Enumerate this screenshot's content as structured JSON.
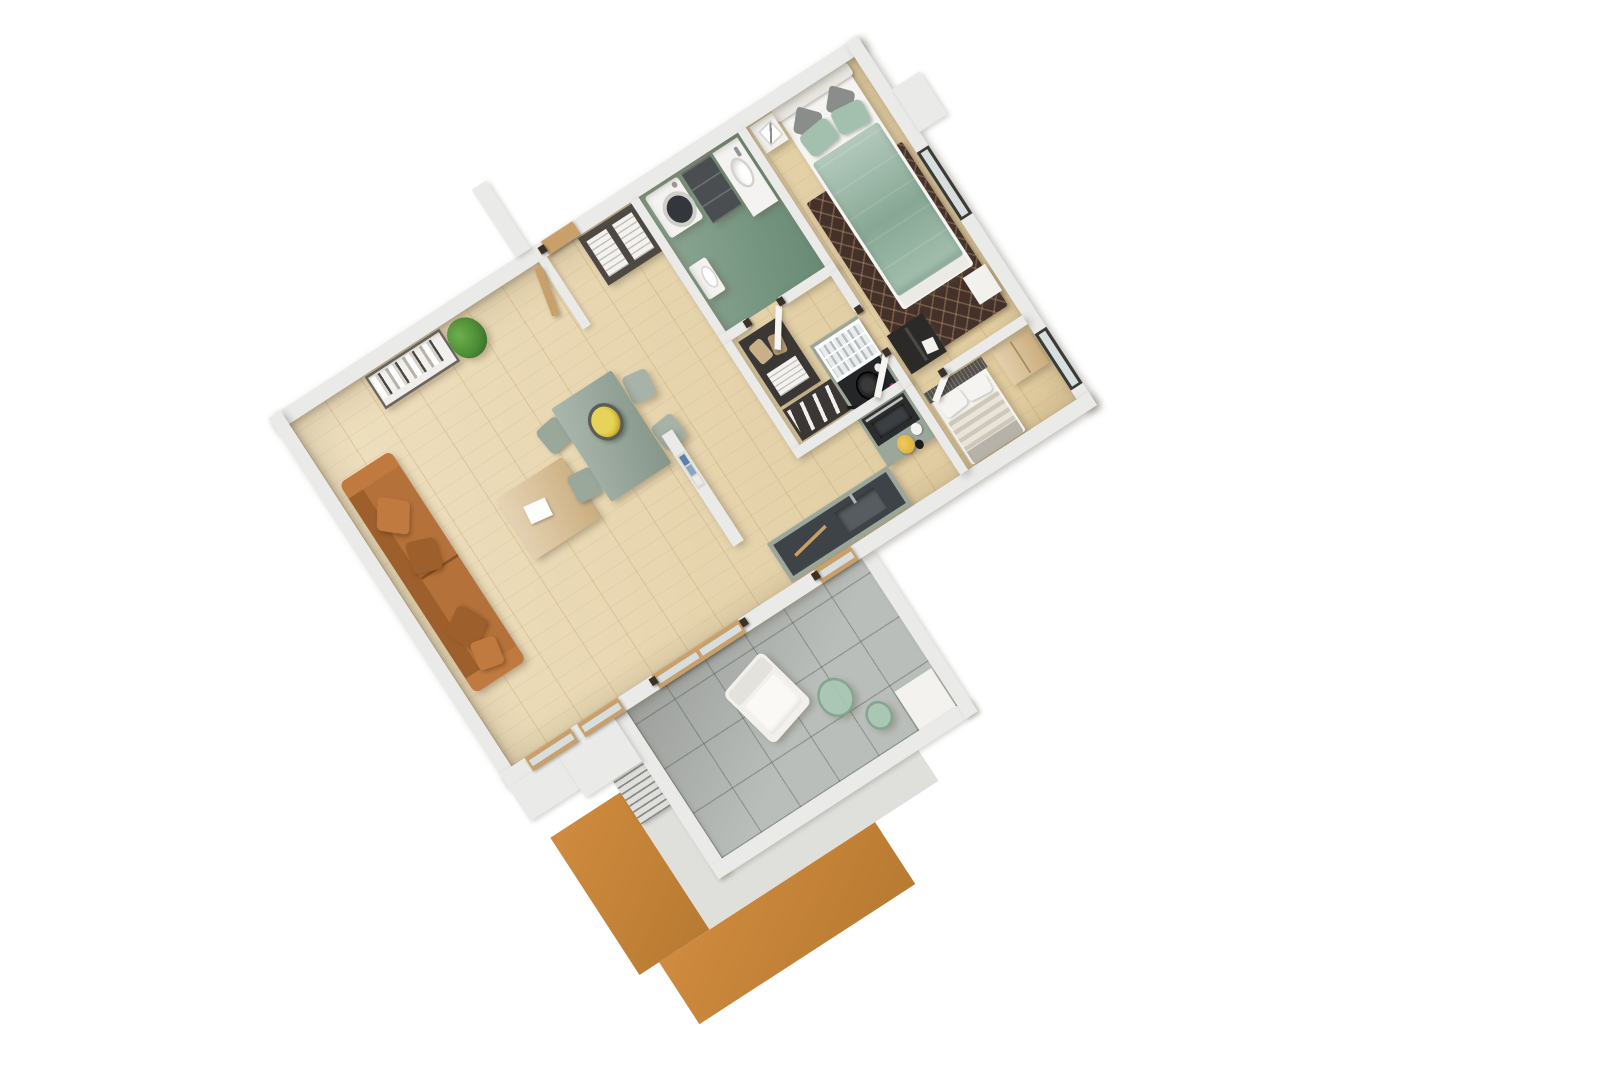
{
  "view": {
    "type": "3D floor plan render",
    "projection": "rotated top-down axonometric",
    "rotation_deg": -33,
    "background": "#ffffff",
    "visible_text": "none"
  },
  "palette": {
    "wall": "#eaeae8",
    "wall_edge": "#d6d6d3",
    "wood_floor": "#e7d2a4",
    "bathroom_floor": "#74957f",
    "balcony_tile": "#babeba",
    "parapet": "#dfdfdc",
    "facade_orange": "#cf8b3f",
    "facade_orange_dark": "#b87a31",
    "sofa": "#b5713a",
    "sofa_dark": "#9d5f2b",
    "sofa_light": "#c07a40",
    "coffee_table": "#d9bd8e",
    "plant_green": "#4c8c36",
    "dining_table": "#93a396",
    "chair": "#9aa89c",
    "fruit_yellow": "#d9c43f",
    "kitchen_cabinet": "#9aa79a",
    "counter_dark": "#3e4347",
    "appliance_dark": "#2a2c2d",
    "steel": "#c8ccce",
    "knob_pink": "#c2366a",
    "bowl_yellow": "#e0b33c",
    "bed_duvet": "#95b5a2",
    "bed_pillow": "#a3c0ae",
    "cushion_gray": "#8b8d8a",
    "mattress_white": "#f5f4f1",
    "rug_brown": "#43312a",
    "rug_pattern": "#8a6e55",
    "nightstand": "#f2f1ee",
    "black_cabinet": "#2b2a28",
    "wardrobe_dark": "#4d4843",
    "linen_white": "#f3f2ef",
    "washer_white": "#f4f3f1",
    "washer_drum": "#33363a",
    "vanity_dark": "#4a4e51",
    "toilet_white": "#f3f2ef",
    "closet_shelf": "#3b3734",
    "shoe_white": "#f1efec",
    "bag_beige": "#c9b089",
    "stripe_light": "#e9e4da",
    "stripe_dark": "#cfc8ba",
    "headboard_mesh": "#55524d",
    "blanket_gray": "#b7b2a9",
    "wood_wardrobe": "#d9bc8c",
    "wood_frame": "#c9a069",
    "window_frame": "#3a3a37",
    "glass": "#d7dede",
    "armchair_white": "#f1f0ed",
    "glass_table": "#a9c7b4",
    "glass_table_ring": "#7fa38e",
    "metal_rail": "#8e8f8b",
    "book_blue": "#5b7fa6",
    "book_light": "#88a7c4"
  },
  "rooms": [
    {
      "id": "living-room",
      "name": "Living room",
      "floor": "light wood planks"
    },
    {
      "id": "dining-area",
      "name": "Dining area",
      "floor": "light wood planks"
    },
    {
      "id": "kitchen",
      "name": "Kitchen",
      "floor": "light wood planks"
    },
    {
      "id": "entry-hall",
      "name": "Entry hall",
      "floor": "light wood planks"
    },
    {
      "id": "bathroom",
      "name": "Bathroom",
      "floor": "sage green tile"
    },
    {
      "id": "walk-in-closet",
      "name": "Walk-in closet",
      "floor": "light wood planks"
    },
    {
      "id": "bedroom",
      "name": "Bedroom",
      "floor": "light wood planks"
    },
    {
      "id": "second-bedroom",
      "name": "Second bedroom",
      "floor": "light wood planks"
    },
    {
      "id": "balcony",
      "name": "Balcony",
      "floor": "grey tiles"
    }
  ],
  "furniture": {
    "living_room": [
      "orange three-seat sofa with cushions",
      "white bookshelf with books and binders",
      "potted green plant",
      "light wood coffee table with white magazine",
      "wood-framed glass doors to balcony"
    ],
    "dining_area": [
      "sage rectangular dining table",
      "four sage chairs",
      "bowl of yellow fruit",
      "half wall with small book shelf"
    ],
    "kitchen": [
      "sage cabinet run with glass-front cabinet",
      "cooktop with black frying pan",
      "dark oven with steel handle",
      "dark countertop with sink and faucet",
      "yellow bowl, white cup, black jar"
    ],
    "entry_hall": [
      "dark open wardrobe with white linens",
      "light wood entrance door"
    ],
    "bathroom": [
      "white washing machine with dark drum",
      "dark drawer unit",
      "white washbasin with faucet",
      "white toilet",
      "open white door"
    ],
    "walk_in_closet": [
      "dark shoe shelf with white shoes",
      "beige bags on shelf"
    ],
    "bedroom": [
      "double bed with sage green duvet and pillows",
      "white headboard",
      "two white nightstands",
      "framed art print",
      "dark brown patterned rug",
      "black open shelf unit",
      "window with dark frame"
    ],
    "second_bedroom": [
      "single bed with striped duvet and mesh headboard",
      "light wood wardrobe",
      "window with dark frame"
    ],
    "balcony": [
      "white outdoor armchair",
      "two green glass side tables",
      "white planter box",
      "metal railing",
      "orange exterior facade wall"
    ]
  }
}
